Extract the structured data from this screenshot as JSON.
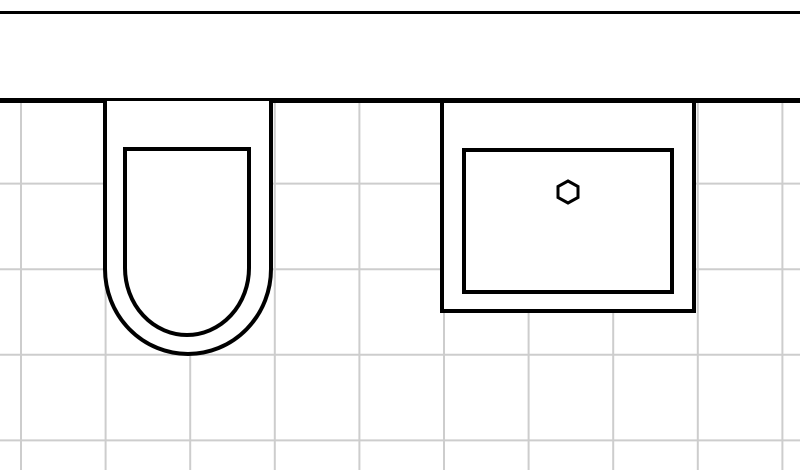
{
  "canvas": {
    "width": 800,
    "height": 470,
    "background": "#ffffff"
  },
  "colors": {
    "line": "#000000",
    "grid_line": "#cdcdcd",
    "fixture_fill": "#ffffff",
    "paper": "#ffffff"
  },
  "grid": {
    "offset_x": 21,
    "offset_y": 98,
    "spacing_x": 84.6,
    "spacing_y": 85.6,
    "stroke_width": 2
  },
  "scene": {
    "type": "bathroom-floor-plan",
    "objects": [
      {
        "id": "wall",
        "kind": "wall-band"
      },
      {
        "id": "toilet",
        "kind": "toilet-top-view"
      },
      {
        "id": "sink",
        "kind": "sink-top-view-with-drain"
      }
    ]
  }
}
